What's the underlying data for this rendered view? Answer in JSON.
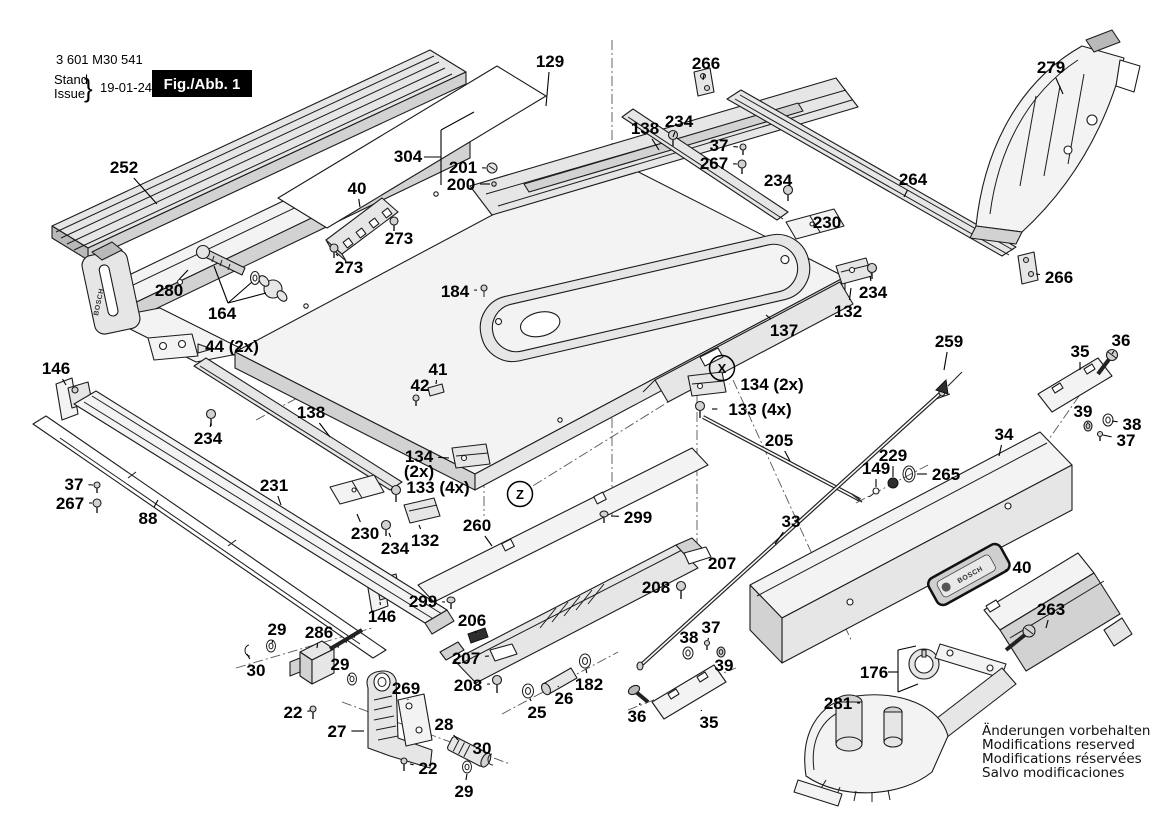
{
  "doc": {
    "part_number": "3 601 M30 541",
    "stand_label": "Stand",
    "issue_label": "Issue",
    "brace": "}",
    "date": "19-01-24",
    "figure": "Fig./Abb. 1",
    "brand": "BOSCH"
  },
  "notice": [
    "Änderungen vorbehalten",
    "Modifications reserved",
    "Modifications réservées",
    "Salvo modificaciones"
  ],
  "diagram": {
    "view_markers": [
      {
        "text": "X",
        "x": 722,
        "y": 368
      },
      {
        "text": "Z",
        "x": 520,
        "y": 494
      }
    ],
    "labels": [
      {
        "t": "252",
        "x": 124,
        "y": 167,
        "lx": 157,
        "ly": 204
      },
      {
        "t": "129",
        "x": 550,
        "y": 61,
        "lx": 546,
        "ly": 106
      },
      {
        "t": "266",
        "x": 706,
        "y": 63,
        "lx": 703,
        "ly": 80
      },
      {
        "t": "279",
        "x": 1051,
        "y": 67,
        "lx": 1063,
        "ly": 94
      },
      {
        "t": "138",
        "x": 645,
        "y": 128,
        "lx": 659,
        "ly": 150
      },
      {
        "t": "234",
        "x": 679,
        "y": 121,
        "lx": 673,
        "ly": 137
      },
      {
        "t": "37",
        "x": 719,
        "y": 145,
        "lx": 738,
        "ly": 147
      },
      {
        "t": "267",
        "x": 714,
        "y": 163,
        "lx": 737,
        "ly": 164
      },
      {
        "t": "234",
        "x": 778,
        "y": 180,
        "lx": 788,
        "ly": 191
      },
      {
        "t": "264",
        "x": 913,
        "y": 179,
        "lx": 904,
        "ly": 197
      },
      {
        "t": "304",
        "x": 408,
        "y": 156
      },
      {
        "t": "201",
        "x": 463,
        "y": 167,
        "lx": 486,
        "ly": 168
      },
      {
        "t": "200",
        "x": 461,
        "y": 184,
        "lx": 490,
        "ly": 184
      },
      {
        "t": "40",
        "x": 357,
        "y": 188,
        "lx": 360,
        "ly": 207
      },
      {
        "t": "273",
        "x": 399,
        "y": 238,
        "lx": 394,
        "ly": 227
      },
      {
        "t": "273",
        "x": 349,
        "y": 267,
        "lx": 336,
        "ly": 254
      },
      {
        "t": "230",
        "x": 827,
        "y": 222,
        "lx": 817,
        "ly": 231
      },
      {
        "t": "266",
        "x": 1059,
        "y": 277,
        "lx": 1036,
        "ly": 274
      },
      {
        "t": "280",
        "x": 169,
        "y": 290,
        "lx": 188,
        "ly": 270
      },
      {
        "t": "164",
        "x": 222,
        "y": 313
      },
      {
        "t": "234",
        "x": 873,
        "y": 292,
        "lx": 870,
        "ly": 276
      },
      {
        "t": "132",
        "x": 848,
        "y": 311,
        "lx": 851,
        "ly": 288
      },
      {
        "t": "184",
        "x": 455,
        "y": 291,
        "lx": 477,
        "ly": 290
      },
      {
        "t": "137",
        "x": 784,
        "y": 330,
        "lx": 766,
        "ly": 315
      },
      {
        "t": "44 (2x)",
        "x": 232,
        "y": 346,
        "lx": 200,
        "ly": 350
      },
      {
        "t": "146",
        "x": 56,
        "y": 368,
        "lx": 66,
        "ly": 385
      },
      {
        "t": "134 (2x)",
        "x": 772,
        "y": 384,
        "lx": 729,
        "ly": 384
      },
      {
        "t": "133 (4x)",
        "x": 760,
        "y": 409,
        "lx": 712,
        "ly": 409
      },
      {
        "t": "259",
        "x": 949,
        "y": 341,
        "lx": 944,
        "ly": 370
      },
      {
        "t": "36",
        "x": 1121,
        "y": 340,
        "lx": 1112,
        "ly": 354
      },
      {
        "t": "35",
        "x": 1080,
        "y": 351,
        "lx": 1080,
        "ly": 370
      },
      {
        "t": "138",
        "x": 311,
        "y": 412,
        "lx": 330,
        "ly": 437
      },
      {
        "t": "41",
        "x": 438,
        "y": 369,
        "lx": 436,
        "ly": 384
      },
      {
        "t": "42",
        "x": 420,
        "y": 385,
        "lx": 416,
        "ly": 394
      },
      {
        "t": "39",
        "x": 1083,
        "y": 411,
        "lx": 1088,
        "ly": 423
      },
      {
        "t": "38",
        "x": 1132,
        "y": 424,
        "lx": 1112,
        "ly": 421
      },
      {
        "t": "37",
        "x": 1126,
        "y": 440,
        "lx": 1103,
        "ly": 435
      },
      {
        "t": "205",
        "x": 779,
        "y": 440,
        "lx": 790,
        "ly": 461
      },
      {
        "t": "34",
        "x": 1004,
        "y": 434,
        "lx": 999,
        "ly": 456
      },
      {
        "t": "229",
        "x": 893,
        "y": 455,
        "lx": 893,
        "ly": 477
      },
      {
        "t": "149",
        "x": 876,
        "y": 468,
        "lx": 876,
        "ly": 487
      },
      {
        "t": "265",
        "x": 946,
        "y": 474,
        "lx": 917,
        "ly": 474
      },
      {
        "t": "231",
        "x": 274,
        "y": 485,
        "lx": 281,
        "ly": 505
      },
      {
        "t": "37",
        "x": 74,
        "y": 484,
        "lx": 93,
        "ly": 485
      },
      {
        "t": "267",
        "x": 70,
        "y": 503,
        "lx": 92,
        "ly": 503
      },
      {
        "t": "88",
        "x": 148,
        "y": 518,
        "lx": 158,
        "ly": 500
      },
      {
        "t": "230",
        "x": 365,
        "y": 533,
        "lx": 357,
        "ly": 514
      },
      {
        "t": "134",
        "x": 419,
        "y": 456,
        "lx": 449,
        "ly": 458
      },
      {
        "t": "(2x)",
        "x": 419,
        "y": 471,
        "s": 15
      },
      {
        "t": "133 (4x)",
        "x": 438,
        "y": 487,
        "lx": 402,
        "ly": 490
      },
      {
        "t": "234",
        "x": 395,
        "y": 548,
        "lx": 389,
        "ly": 533
      },
      {
        "t": "132",
        "x": 425,
        "y": 540,
        "lx": 419,
        "ly": 525
      },
      {
        "t": "260",
        "x": 477,
        "y": 525,
        "lx": 492,
        "ly": 546
      },
      {
        "t": "299",
        "x": 638,
        "y": 517,
        "lx": 611,
        "ly": 516
      },
      {
        "t": "33",
        "x": 791,
        "y": 521,
        "lx": 775,
        "ly": 544
      },
      {
        "t": "299",
        "x": 423,
        "y": 601,
        "lx": 445,
        "ly": 602
      },
      {
        "t": "146",
        "x": 382,
        "y": 616,
        "lx": 380,
        "ly": 602
      },
      {
        "t": "206",
        "x": 472,
        "y": 620,
        "lx": 476,
        "ly": 633
      },
      {
        "t": "286",
        "x": 319,
        "y": 632,
        "lx": 317,
        "ly": 648
      },
      {
        "t": "29",
        "x": 277,
        "y": 629,
        "lx": 272,
        "ly": 643
      },
      {
        "t": "30",
        "x": 256,
        "y": 670,
        "lx": 247,
        "ly": 654
      },
      {
        "t": "29",
        "x": 340,
        "y": 664,
        "lx": 350,
        "ly": 676
      },
      {
        "t": "207",
        "x": 466,
        "y": 658,
        "lx": 489,
        "ly": 656
      },
      {
        "t": "208",
        "x": 468,
        "y": 685,
        "lx": 490,
        "ly": 684
      },
      {
        "t": "22",
        "x": 293,
        "y": 712,
        "lx": 310,
        "ly": 711
      },
      {
        "t": "27",
        "x": 337,
        "y": 731,
        "lx": 364,
        "ly": 731
      },
      {
        "t": "269",
        "x": 406,
        "y": 688,
        "lx": 408,
        "ly": 700
      },
      {
        "t": "28",
        "x": 444,
        "y": 724,
        "lx": 458,
        "ly": 740
      },
      {
        "t": "25",
        "x": 537,
        "y": 712,
        "lx": 530,
        "ly": 699
      },
      {
        "t": "26",
        "x": 564,
        "y": 698,
        "lx": 558,
        "ly": 686
      },
      {
        "t": "182",
        "x": 589,
        "y": 684,
        "lx": 586,
        "ly": 669
      },
      {
        "t": "36",
        "x": 637,
        "y": 716,
        "lx": 640,
        "ly": 703
      },
      {
        "t": "35",
        "x": 709,
        "y": 722,
        "lx": 701,
        "ly": 710
      },
      {
        "t": "38",
        "x": 689,
        "y": 637,
        "lx": 688,
        "ly": 648
      },
      {
        "t": "37",
        "x": 711,
        "y": 627,
        "lx": 708,
        "ly": 640
      },
      {
        "t": "39",
        "x": 724,
        "y": 665,
        "lx": 721,
        "ly": 655
      },
      {
        "t": "207",
        "x": 722,
        "y": 563,
        "lx": 704,
        "ly": 560
      },
      {
        "t": "208",
        "x": 656,
        "y": 587,
        "lx": 674,
        "ly": 588
      },
      {
        "t": "30",
        "x": 482,
        "y": 748,
        "lx": 488,
        "ly": 757
      },
      {
        "t": "22",
        "x": 428,
        "y": 768,
        "lx": 410,
        "ly": 764
      },
      {
        "t": "29",
        "x": 464,
        "y": 791,
        "lx": 467,
        "ly": 774
      },
      {
        "t": "176",
        "x": 874,
        "y": 672
      },
      {
        "t": "281",
        "x": 838,
        "y": 703,
        "lx": 860,
        "ly": 703
      },
      {
        "t": "40",
        "x": 1022,
        "y": 567,
        "lx": 1005,
        "ly": 570
      },
      {
        "t": "263",
        "x": 1051,
        "y": 609,
        "lx": 1046,
        "ly": 628
      },
      {
        "t": "234",
        "x": 208,
        "y": 438,
        "lx": 211,
        "ly": 423
      }
    ]
  }
}
